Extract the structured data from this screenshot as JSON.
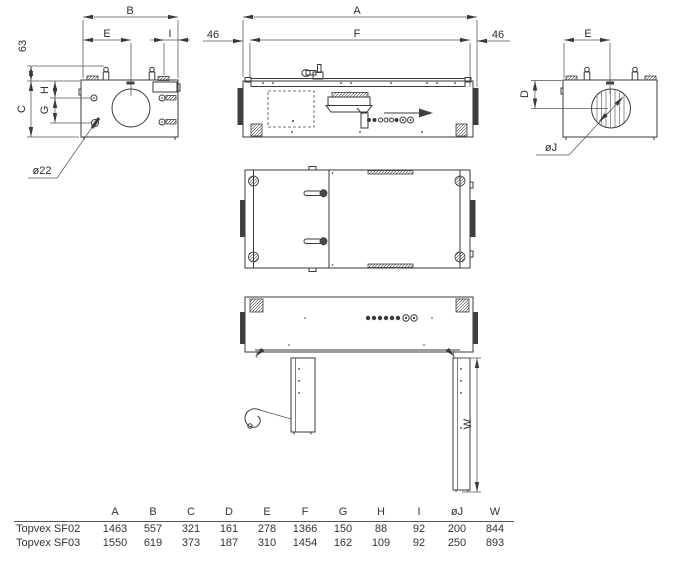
{
  "views": {
    "front": {
      "dims": {
        "B": "B",
        "E": "E",
        "I": "I",
        "n63": "63",
        "C": "C",
        "G": "G",
        "H": "H",
        "d22": "ø22"
      }
    },
    "side": {
      "dims": {
        "A": "A",
        "F": "F",
        "left46": "46",
        "right46": "46"
      }
    },
    "end": {
      "dims": {
        "E": "E",
        "D": "D",
        "dJ": "øJ"
      }
    },
    "open": {
      "dims": {
        "W": "W"
      }
    }
  },
  "table": {
    "columns": [
      "A",
      "B",
      "C",
      "D",
      "E",
      "F",
      "G",
      "H",
      "I",
      "øJ",
      "W"
    ],
    "rows": [
      {
        "model": "Topvex SF02",
        "values": [
          "1463",
          "557",
          "321",
          "161",
          "278",
          "1366",
          "150",
          "88",
          "92",
          "200",
          "844"
        ]
      },
      {
        "model": "Topvex SF03",
        "values": [
          "1550",
          "619",
          "373",
          "187",
          "310",
          "1454",
          "162",
          "109",
          "92",
          "250",
          "893"
        ]
      }
    ]
  }
}
